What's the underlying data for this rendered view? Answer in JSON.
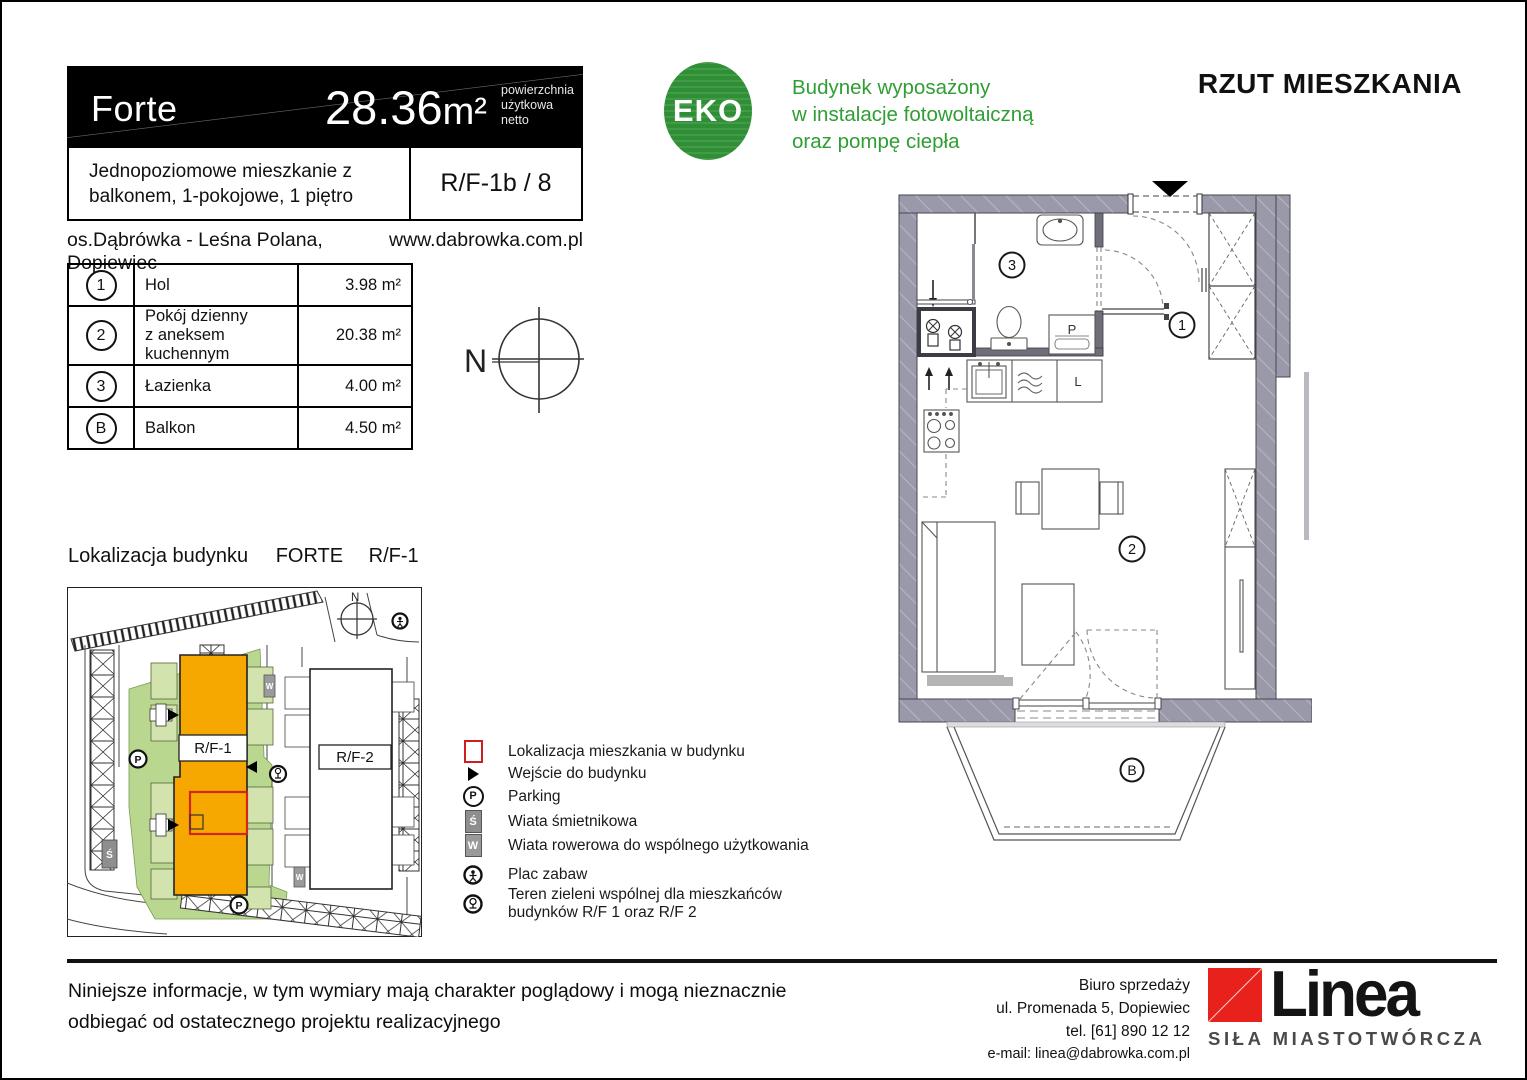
{
  "header": {
    "project_name": "Forte",
    "area_value": "28.36",
    "area_unit": "m²",
    "area_caption": [
      "powierzchnia",
      "użytkowa",
      "netto"
    ],
    "description_line1": "Jednopoziomowe mieszkanie z",
    "description_line2": "balkonem, 1-pokojowe, 1 piętro",
    "unit_code": "R/F-1b / 8",
    "location": "os.Dąbrówka - Leśna Polana, Dopiewiec",
    "website": "www.dabrowka.com.pl"
  },
  "eco": {
    "badge_label": "EKO",
    "lines": [
      "Budynek wyposażony",
      "w instalacje fotowoltaiczną",
      "oraz pompę ciepła"
    ]
  },
  "page_title": "RZUT MIESZKANIA",
  "rooms_table": {
    "rows": [
      {
        "id": "1",
        "name_line1": "Hol",
        "name_line2": "",
        "area": "3.98 m²"
      },
      {
        "id": "2",
        "name_line1": "Pokój dzienny",
        "name_line2": "z aneksem kuchennym",
        "area": "20.38 m²"
      },
      {
        "id": "3",
        "name_line1": "Łazienka",
        "name_line2": "",
        "area": "4.00 m²"
      },
      {
        "id": "B",
        "name_line1": "Balkon",
        "name_line2": "",
        "area": "4.50 m²"
      }
    ]
  },
  "compass": {
    "north_label": "N"
  },
  "floor_plan": {
    "labels": {
      "hol": "1",
      "living": "2",
      "bath": "3",
      "balcony": "B",
      "washer": "P",
      "fridge": "L"
    }
  },
  "site_plan": {
    "section_label": "Lokalizacja budynku",
    "building_name": "FORTE",
    "building_code": "R/F-1",
    "map": {
      "north_label": "N",
      "rf1_label": "R/F-1",
      "rf2_label": "R/F-2",
      "parking_label": "P",
      "trash_label": "Ś",
      "bike_label": "W"
    }
  },
  "legend": {
    "items": [
      {
        "label": "Lokalizacja mieszkania w budynku"
      },
      {
        "label": "Wejście do budynku"
      },
      {
        "label": "Parking"
      },
      {
        "label": "Wiata śmietnikowa"
      },
      {
        "label": "Wiata rowerowa do wspólnego użytkowania"
      },
      {
        "label": "Plac zabaw"
      },
      {
        "label": "Teren zieleni wspólnej dla mieszkańców",
        "label2": "budynków R/F 1 oraz R/F 2"
      }
    ]
  },
  "footer": {
    "disclaimer_line1": "Niniejsze informacje, w tym wymiary mają charakter poglądowy i mogą nieznacznie",
    "disclaimer_line2": "odbiegać od ostatecznego projektu realizacyjnego",
    "office": {
      "line1": "Biuro sprzedaży",
      "line2": "ul. Promenada 5, Dopiewiec",
      "line3": "tel. [61] 890 12 12",
      "line4": "e-mail: linea@dabrowka.com.pl"
    },
    "logo": {
      "brand": "Linea",
      "tagline": "SIŁA MIASTOTWÓRCZA"
    }
  },
  "colors": {
    "accent_orange": "#F6A800",
    "eco_green": "#2E8F35",
    "text_green": "#2F9E33",
    "logo_red": "#E8211D",
    "wall_gray": "#9A99A9",
    "highlight_red": "#D02818"
  }
}
